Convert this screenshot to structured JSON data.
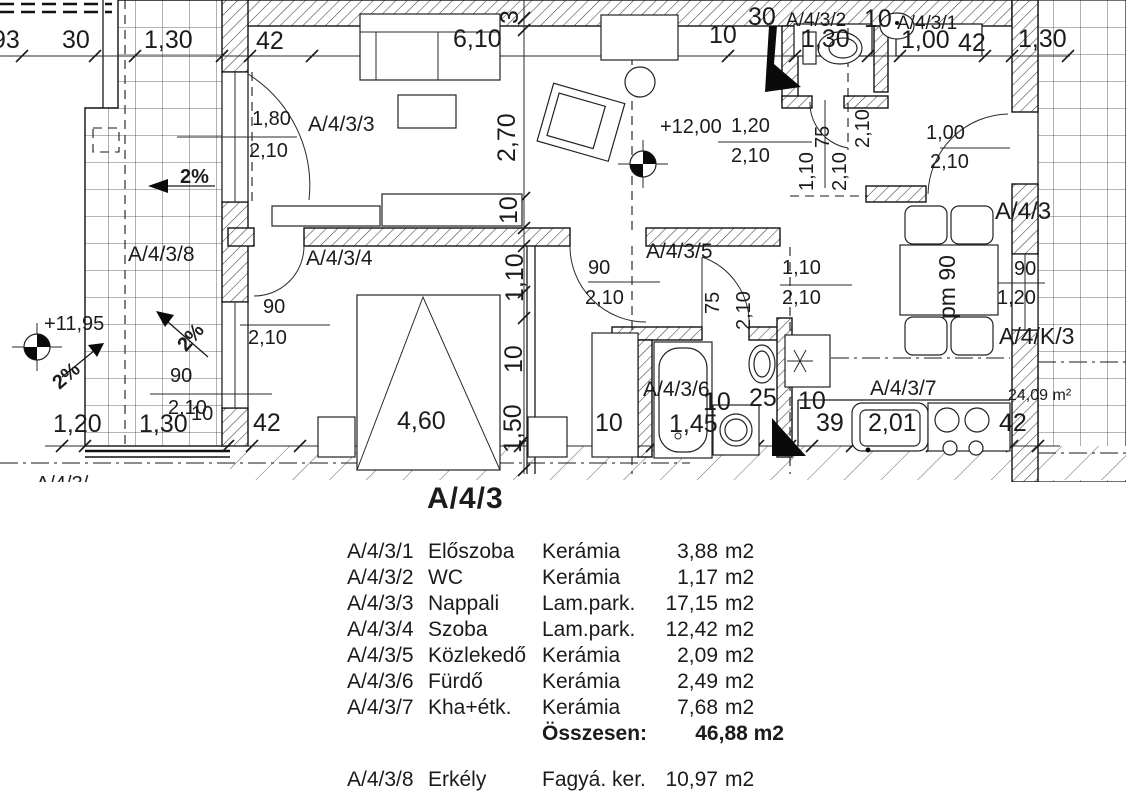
{
  "title": {
    "text": "A/4/3"
  },
  "legend": {
    "rows": [
      {
        "code": "A/4/3/1",
        "name": "Előszoba",
        "material": "Kerámia",
        "area_value": "3,88",
        "area_unit": "m2"
      },
      {
        "code": "A/4/3/2",
        "name": "WC",
        "material": "Kerámia",
        "area_value": "1,17",
        "area_unit": "m2"
      },
      {
        "code": "A/4/3/3",
        "name": "Nappali",
        "material": "Lam.park.",
        "area_value": "17,15",
        "area_unit": "m2"
      },
      {
        "code": "A/4/3/4",
        "name": "Szoba",
        "material": "Lam.park.",
        "area_value": "12,42",
        "area_unit": "m2"
      },
      {
        "code": "A/4/3/5",
        "name": "Közlekedő",
        "material": "Kerámia",
        "area_value": "2,09",
        "area_unit": "m2"
      },
      {
        "code": "A/4/3/6",
        "name": "Fürdő",
        "material": "Kerámia",
        "area_value": "2,49",
        "area_unit": "m2"
      },
      {
        "code": "A/4/3/7",
        "name": "Kha+étk.",
        "material": "Kerámia",
        "area_value": "7,68",
        "area_unit": "m2"
      }
    ],
    "total": {
      "label": "Összesen:",
      "value": "46,88 m2"
    },
    "extra_rows": [
      {
        "code": "A/4/3/8",
        "name": "Erkély",
        "material": "Fagyá. ker.",
        "area_value": "10,97",
        "area_unit": "m2"
      }
    ]
  },
  "plan": {
    "labels": [
      {
        "t": "93",
        "x": -8,
        "y": 28,
        "fs": 25
      },
      {
        "t": "30",
        "x": 62,
        "y": 28,
        "fs": 25
      },
      {
        "t": "1,30",
        "x": 144,
        "y": 28,
        "fs": 25
      },
      {
        "t": "42",
        "x": 256,
        "y": 29,
        "fs": 25
      },
      {
        "t": "6,10",
        "x": 453,
        "y": 27,
        "fs": 25
      },
      {
        "t": "3",
        "x": 498,
        "y": 24,
        "fs": 25,
        "r": -90
      },
      {
        "t": "30",
        "x": 748,
        "y": 5,
        "fs": 25
      },
      {
        "t": "10",
        "x": 709,
        "y": 23,
        "fs": 25
      },
      {
        "t": "A/4/3/2",
        "x": 786,
        "y": 11,
        "fs": 19
      },
      {
        "t": "10",
        "x": 864,
        "y": 7,
        "fs": 25
      },
      {
        "t": "A/4/3/1",
        "x": 897,
        "y": 14,
        "fs": 19
      },
      {
        "t": "1,30",
        "x": 801,
        "y": 27,
        "fs": 25
      },
      {
        "t": "1,00",
        "x": 901,
        "y": 28,
        "fs": 25
      },
      {
        "t": "42",
        "x": 958,
        "y": 31,
        "fs": 25
      },
      {
        "t": "1,30",
        "x": 1018,
        "y": 27,
        "fs": 25
      },
      {
        "t": "2,70",
        "x": 495,
        "y": 162,
        "fs": 25,
        "r": -90
      },
      {
        "t": "10",
        "x": 497,
        "y": 224,
        "fs": 25,
        "r": -90
      },
      {
        "t": "1,80",
        "x": 252,
        "y": 109,
        "fs": 20
      },
      {
        "t": "2,10",
        "x": 249,
        "y": 141,
        "fs": 20
      },
      {
        "t": "A/4/3/3",
        "x": 308,
        "y": 114,
        "fs": 21
      },
      {
        "t": "2%",
        "x": 180,
        "y": 167,
        "fs": 20,
        "b": 1
      },
      {
        "t": "+12,00",
        "x": 660,
        "y": 117,
        "fs": 20
      },
      {
        "t": "1,20",
        "x": 731,
        "y": 116,
        "fs": 20
      },
      {
        "t": "2,10",
        "x": 731,
        "y": 146,
        "fs": 20
      },
      {
        "t": "1,10",
        "x": 797,
        "y": 191,
        "fs": 20,
        "r": -90
      },
      {
        "t": "2,10",
        "x": 830,
        "y": 191,
        "fs": 20,
        "r": -90
      },
      {
        "t": "75",
        "x": 813,
        "y": 148,
        "fs": 20,
        "r": -90
      },
      {
        "t": "2,10",
        "x": 853,
        "y": 148,
        "fs": 20,
        "r": -90
      },
      {
        "t": "1,00",
        "x": 926,
        "y": 123,
        "fs": 20
      },
      {
        "t": "2,10",
        "x": 930,
        "y": 152,
        "fs": 20
      },
      {
        "t": "A/4/3",
        "x": 995,
        "y": 200,
        "fs": 24
      },
      {
        "t": "A/4/3/8",
        "x": 128,
        "y": 244,
        "fs": 21
      },
      {
        "t": "A/4/3/4",
        "x": 306,
        "y": 248,
        "fs": 21
      },
      {
        "t": "A/4/3/5",
        "x": 646,
        "y": 241,
        "fs": 21
      },
      {
        "t": "1,10",
        "x": 503,
        "y": 302,
        "fs": 25,
        "r": -90
      },
      {
        "t": "90",
        "x": 263,
        "y": 297,
        "fs": 20
      },
      {
        "t": "2,10",
        "x": 248,
        "y": 328,
        "fs": 20
      },
      {
        "t": "90",
        "x": 588,
        "y": 258,
        "fs": 20
      },
      {
        "t": "2,10",
        "x": 585,
        "y": 288,
        "fs": 20
      },
      {
        "t": "75",
        "x": 703,
        "y": 314,
        "fs": 20,
        "r": -90
      },
      {
        "t": "2,10",
        "x": 734,
        "y": 330,
        "fs": 20,
        "r": -90
      },
      {
        "t": "1,10",
        "x": 782,
        "y": 258,
        "fs": 20
      },
      {
        "t": "2,10",
        "x": 782,
        "y": 288,
        "fs": 20
      },
      {
        "t": "pm 90",
        "x": 936,
        "y": 319,
        "fs": 23,
        "r": -90
      },
      {
        "t": "90",
        "x": 1014,
        "y": 259,
        "fs": 20
      },
      {
        "t": "1,20",
        "x": 997,
        "y": 288,
        "fs": 20
      },
      {
        "t": "A/4/K/3",
        "x": 999,
        "y": 325,
        "fs": 23
      },
      {
        "t": "+11,95",
        "x": 44,
        "y": 314,
        "fs": 20
      },
      {
        "t": "2%",
        "x": 174,
        "y": 342,
        "fs": 20,
        "r": -49,
        "b": 1
      },
      {
        "t": "2%",
        "x": 49,
        "y": 378,
        "fs": 20,
        "r": -41,
        "b": 1
      },
      {
        "t": "90",
        "x": 170,
        "y": 366,
        "fs": 20
      },
      {
        "t": "2,10",
        "x": 168,
        "y": 398,
        "fs": 20
      },
      {
        "t": "24,09 m²",
        "x": 1008,
        "y": 388,
        "fs": 16
      },
      {
        "t": "1,20",
        "x": 53,
        "y": 412,
        "fs": 25
      },
      {
        "t": "1,30",
        "x": 139,
        "y": 412,
        "fs": 25
      },
      {
        "t": "10",
        "x": 191,
        "y": 404,
        "fs": 20
      },
      {
        "t": "42",
        "x": 253,
        "y": 411,
        "fs": 25
      },
      {
        "t": "4,60",
        "x": 397,
        "y": 409,
        "fs": 25
      },
      {
        "t": "10",
        "x": 502,
        "y": 373,
        "fs": 25,
        "r": -90
      },
      {
        "t": "1,50",
        "x": 501,
        "y": 453,
        "fs": 25,
        "r": -90
      },
      {
        "t": "10",
        "x": 595,
        "y": 411,
        "fs": 25
      },
      {
        "t": "A/4/3/6",
        "x": 643,
        "y": 379,
        "fs": 21
      },
      {
        "t": "10",
        "x": 703,
        "y": 390,
        "fs": 25
      },
      {
        "t": "25",
        "x": 749,
        "y": 386,
        "fs": 25
      },
      {
        "t": "1,45",
        "x": 669,
        "y": 412,
        "fs": 25
      },
      {
        "t": "10",
        "x": 798,
        "y": 389,
        "fs": 25
      },
      {
        "t": "39",
        "x": 816,
        "y": 411,
        "fs": 25
      },
      {
        "t": "2,01",
        "x": 868,
        "y": 411,
        "fs": 25
      },
      {
        "t": "A/4/3/7",
        "x": 870,
        "y": 378,
        "fs": 21
      },
      {
        "t": "42",
        "x": 999,
        "y": 411,
        "fs": 25
      },
      {
        "t": "A/4/3/",
        "x": 36,
        "y": 474,
        "fs": 20
      }
    ]
  },
  "colors": {
    "ink": "#1b1b1d",
    "paper": "#ffffff",
    "hatch": "#3d3d3d",
    "sparse_hatch": "#707070",
    "tile_grid": "#3c3c3c"
  }
}
